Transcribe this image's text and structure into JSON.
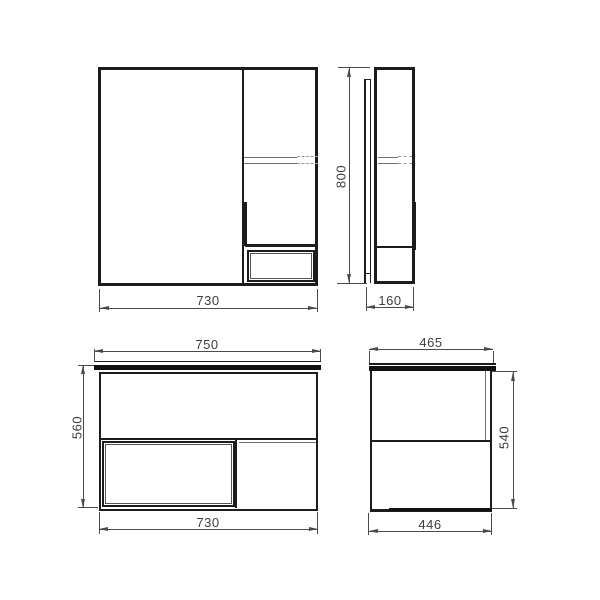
{
  "drawing": {
    "colors": {
      "background": "#ffffff",
      "outline": "#1c1c1c",
      "dimension": "#4a4a4a",
      "hidden_line": "#9a9a9a"
    },
    "views": {
      "mirror_front": {
        "width_dim": "730"
      },
      "mirror_side": {
        "height_dim": "800",
        "depth_dim": "160"
      },
      "vanity_front": {
        "countertop_width_dim": "750",
        "height_dim": "560",
        "body_width_dim": "730"
      },
      "vanity_side": {
        "countertop_depth_dim": "465",
        "height_dim": "540",
        "body_depth_dim": "446"
      }
    }
  }
}
